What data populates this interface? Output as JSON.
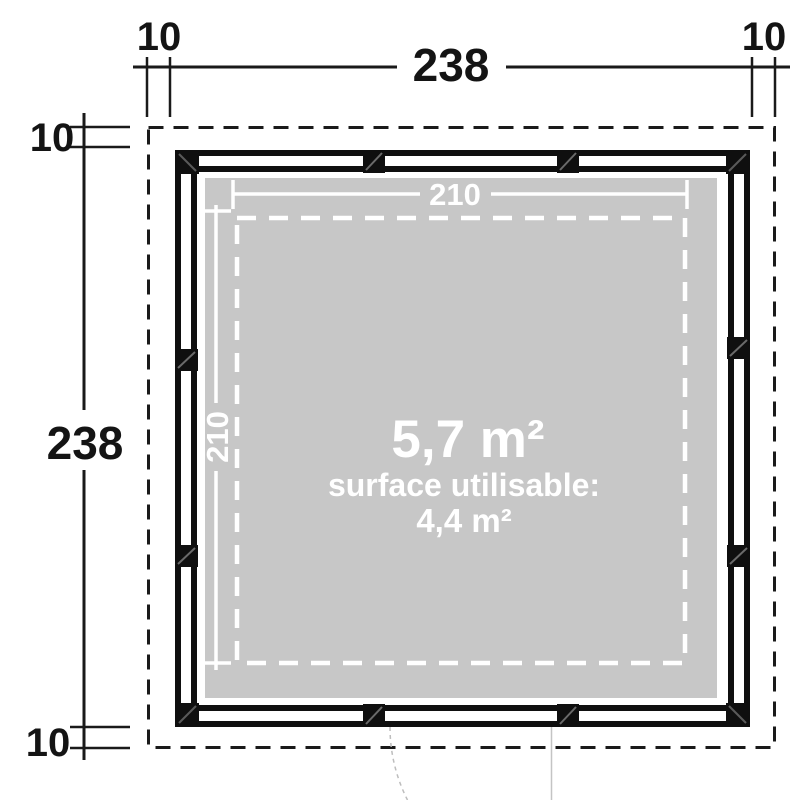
{
  "plan": {
    "overall": {
      "width_label": "238",
      "height_label": "238",
      "overhang_top_left": "10",
      "overhang_top_right": "10",
      "overhang_side_top": "10",
      "overhang_side_bottom": "10"
    },
    "interior": {
      "width_label": "210",
      "height_label": "210"
    },
    "area": {
      "gross_label": "5,7 m²",
      "usable_caption": "surface utilisable:",
      "usable_label": "4,4 m²"
    },
    "colors": {
      "background": "#ffffff",
      "wall": "#0f0f0f",
      "floor": "#c7c7c7",
      "dimension_lines": "#1a1a1a",
      "interior_markings": "#ffffff",
      "door_swing": "#bdbdbd"
    }
  }
}
